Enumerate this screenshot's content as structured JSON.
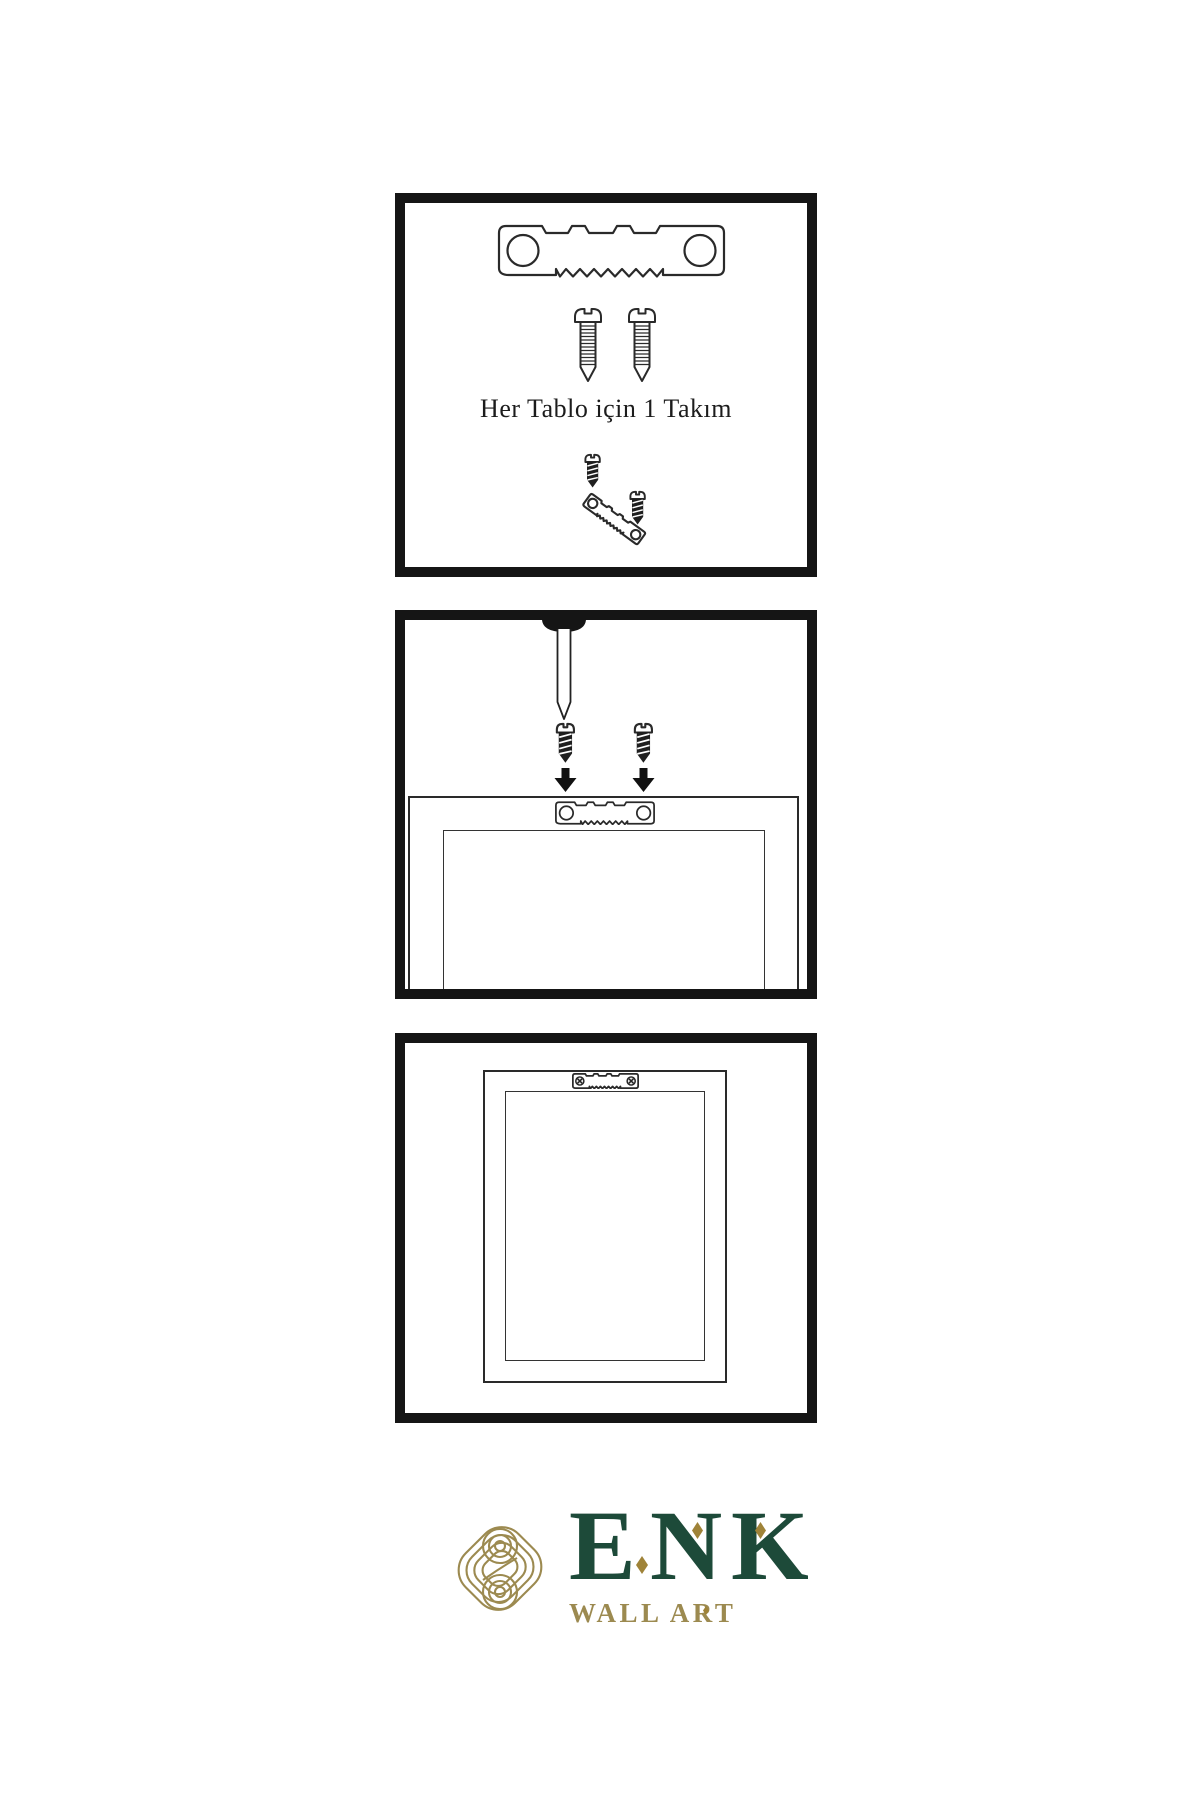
{
  "colors": {
    "background": "#ffffff",
    "panel_border": "#151515",
    "line": "#2a2a2a",
    "fill_dark": "#1f1f1f",
    "brand_green": "#1d4a39",
    "brand_gold": "#9c8a50",
    "accent_gold": "#9f8338"
  },
  "steps": [
    {
      "id": 1,
      "caption": "Her Tablo için 1 Takım",
      "icons": [
        "sawtooth-hanger-icon",
        "screw-icon",
        "screw-icon",
        "screw-driven-into-angled-hanger-icon"
      ]
    },
    {
      "id": 2,
      "icons": [
        "nail-in-wall-icon",
        "screw-icon",
        "screw-icon",
        "arrow-down-icon",
        "arrow-down-icon",
        "sawtooth-hanger-on-frame-icon",
        "picture-frame-icon"
      ]
    },
    {
      "id": 3,
      "icons": [
        "picture-frame-icon",
        "installed-sawtooth-hanger-icon"
      ]
    }
  ],
  "logo": {
    "letters": [
      "E",
      "N",
      "K"
    ],
    "subtitle": "WALL ART",
    "mark": "interlocking-knot-icon"
  }
}
